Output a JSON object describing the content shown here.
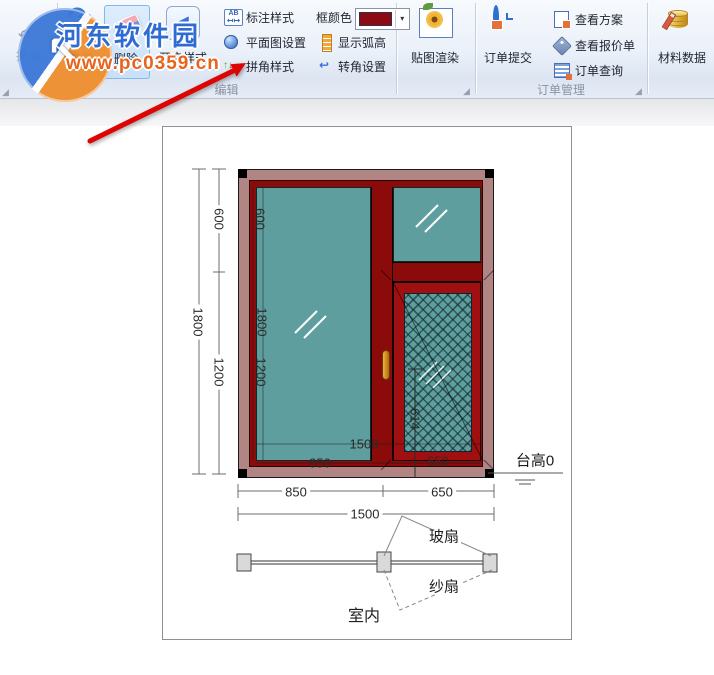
{
  "ribbon": {
    "undo": "撤消",
    "redo": "重做",
    "delete": "删除",
    "open_style": "开启样式",
    "dim_style": "标注样式",
    "dim_style_icon_text": "AB",
    "plan_settings": "平面图设置",
    "corner_style": "拼角样式",
    "frame_color": "框颜色",
    "frame_color_value": "#8b0a16",
    "show_arc": "显示弧高",
    "corner_settings": "转角设置",
    "render": "贴图渲染",
    "order_submit": "订单提交",
    "view_plan": "查看方案",
    "view_quote": "查看报价单",
    "order_query": "订单查询",
    "material_data": "材料数据",
    "group_edit": "编辑",
    "group_order": "订单管理"
  },
  "icons": {
    "dropdown": "▾",
    "undo_glyph": "↶",
    "redo_glyph": "↷",
    "open_glyph": "◀",
    "corner_settings_glyph": "↩",
    "arrow_up": "↑",
    "arrow_down": "↓",
    "arrow_right": "→",
    "launcher": "◢",
    "logo_arrow": "↖"
  },
  "watermark": {
    "name": "河东软件园",
    "url": "www.pc0359.cn"
  },
  "drawing": {
    "height_total": "1800",
    "height_top": "600",
    "height_bottom": "1200",
    "inner_height_top": "600",
    "inner_height_total": "1800",
    "inner_height_bottom": "1200",
    "inner_width_total": "1500",
    "inner_width_left": "850",
    "inner_width_right": "650",
    "mesh_height": "614",
    "width_left": "850",
    "width_right": "650",
    "width_total": "1500",
    "platform": "台高0",
    "glass_sash": "玻扇",
    "screen_sash": "纱扇",
    "indoor": "室内",
    "colors": {
      "frame_outer": "#b28585",
      "frame_inner": "#8b0b0b",
      "glass": "#5f9e9e"
    }
  }
}
